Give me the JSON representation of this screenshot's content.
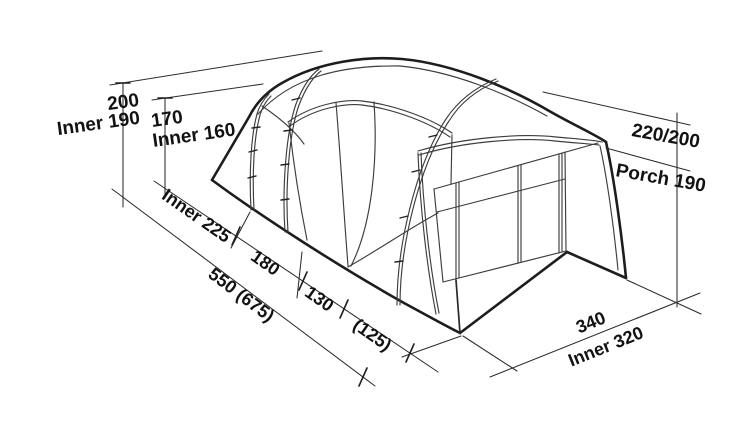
{
  "diagram": {
    "subject": "tent-dimension-diagram",
    "colors": {
      "background": "#ffffff",
      "line_bold": "#1d1d1d",
      "line_thin": "#3d3d3d",
      "text": "#121212"
    },
    "dimensions": {
      "left_height": {
        "value": "200",
        "inner": "Inner 190"
      },
      "mid_height": {
        "value": "170",
        "inner": "Inner 160"
      },
      "right_height": {
        "value": "220/200",
        "porch": "Porch 190"
      },
      "length": {
        "segment1": "Inner 225",
        "segment2": "180",
        "segment3": "130",
        "segment4": "(125)",
        "total": "550 (675)"
      },
      "width": {
        "value": "340",
        "inner": "Inner 320"
      }
    }
  }
}
